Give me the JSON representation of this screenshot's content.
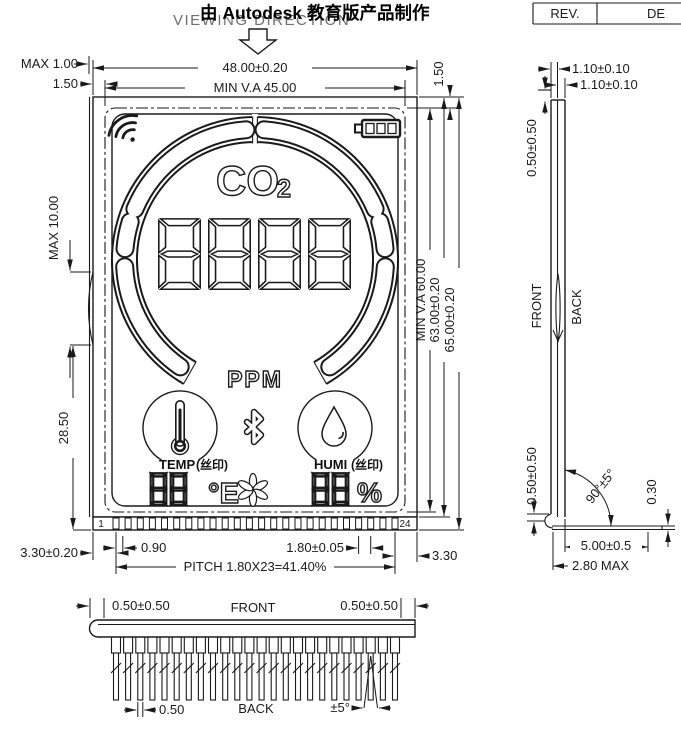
{
  "colors": {
    "line": "#1a1a1a",
    "watermark_text": "#000000",
    "viewing_direction_text": "#6e6e6e",
    "background": "#ffffff"
  },
  "header": {
    "viewing_direction": "VIEWING DIRECTION",
    "watermark": "由 Autodesk 教育版产品制作",
    "title_block": {
      "rev": "REV.",
      "description": "DE"
    }
  },
  "front": {
    "dims": {
      "overall_width": "48.00±0.20",
      "va_width": "MIN V.A 45.00",
      "max_top_offset": "MAX 1.00",
      "top_offset_left": "1.50",
      "top_offset_right": "1.50",
      "bump_height": "MAX 10.00",
      "bump_to_bottom": "28.50",
      "va_height": "MIN V.A 60.00",
      "glass_height": "63.00±0.20",
      "overall_height": "65.00±0.20",
      "pin_first": "1",
      "pin_last": "24",
      "pin_end_offset": "0.90",
      "pin_pitch": "1.80±0.05",
      "pitch_total": "PITCH 1.80X23=41.40%",
      "pin_margin_left": "3.30±0.20",
      "pin_margin_right": "3.30"
    },
    "lcd": {
      "gas_label": "CO",
      "gas_subscript": "2",
      "unit_label": "PPM",
      "temp_label": "TEMP",
      "temp_note": "(丝印)",
      "temp_unit": "°E",
      "humi_label": "HUMI",
      "humi_note": "(丝印)",
      "humi_unit": "%",
      "icons": [
        "wifi-icon",
        "battery-icon",
        "co2-gauge-ring",
        "seven-segment-digits",
        "bluetooth-icon",
        "thermometer-icon",
        "water-drop-icon",
        "fan-icon"
      ]
    }
  },
  "side": {
    "labels": {
      "front": "FRONT",
      "back": "BACK"
    },
    "dims": {
      "front_glass": "1.10±0.10",
      "back_glass": "1.10±0.10",
      "top_edge_offset": "0.50±0.50",
      "bottom_edge_offset": "0.50±0.50",
      "bend_angle": "90°±5°",
      "pin_thickness": "0.30",
      "pin_length": "5.00±0.5",
      "bend_max": "2.80 MAX"
    }
  },
  "bottom": {
    "labels": {
      "front": "FRONT",
      "back": "BACK"
    },
    "dims": {
      "edge_left": "0.50±0.50",
      "edge_right": "0.50±0.50",
      "pin_width": "0.50",
      "splay": "±5°"
    }
  }
}
